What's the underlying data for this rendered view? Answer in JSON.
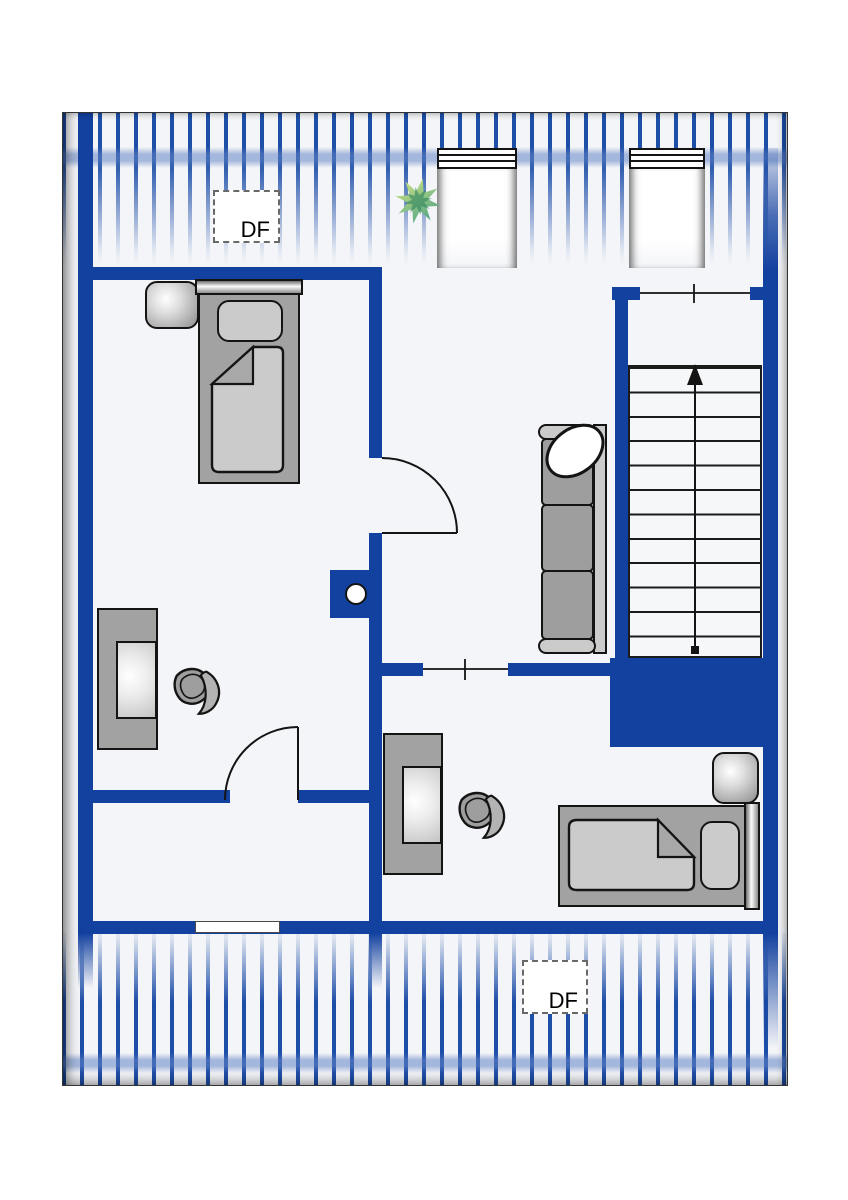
{
  "floor_plan": {
    "labels": {
      "roof_window_top": "DF",
      "roof_window_bottom": "DF"
    },
    "stairs": {
      "steps": 12,
      "direction": "up"
    },
    "counts": {
      "roof_windows_df": 2,
      "top_wall_windows": 2,
      "bottom_wall_windows": 1,
      "beds": 2,
      "nightstands": 2,
      "desks": 2,
      "office_chairs": 2,
      "sofas": 1,
      "plants": 1,
      "interior_doors": 2,
      "open_passages": 2,
      "chimneys": 1,
      "staircases": 1
    },
    "colors": {
      "page": "#ffffff",
      "floor": "#f4f5f8",
      "wall": "#12419f",
      "stripe": "#1e4fa8",
      "outline": "#141414",
      "furniture_gray": "#a2a2a2",
      "furniture_light": "#cbcbcb",
      "cushion_gray": "#9e9e9e",
      "plant_light": "#dcea83",
      "plant_dark": "#3c9a84"
    }
  }
}
